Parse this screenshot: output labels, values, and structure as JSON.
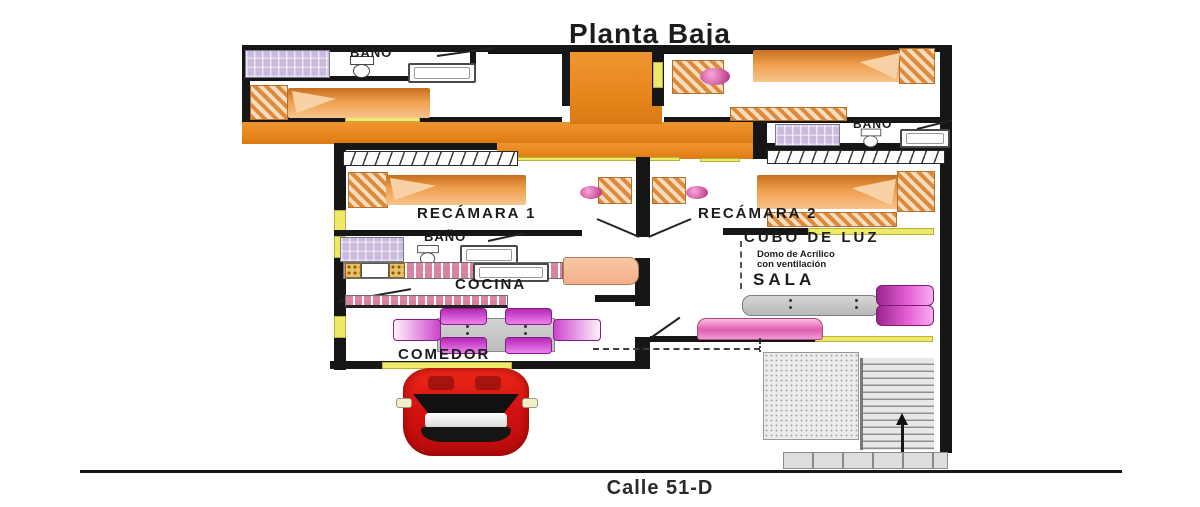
{
  "title": "Planta Baja",
  "street": "Calle 51-D",
  "labels": {
    "bano_top_left": "BAÑO",
    "bano_right": "BAÑO",
    "bano_middle": "BAÑO",
    "recamara_1": "RECÁMARA 1",
    "recamara_2": "RECÁMARA 2",
    "cocina": "COCINA",
    "comedor": "COMEDOR",
    "sala": "SALA",
    "cubo_de_luz": "CUBO DE LUZ",
    "cubo_note_1": "Domo de Acrílico",
    "cubo_note_2": "con ventilación"
  },
  "colors": {
    "hallway_orange": "#E8871E",
    "door_marker_yellow": "#EFE96A",
    "wall_black": "#161616",
    "furniture_magenta": "#C637C6",
    "shower_lilac": "#C9B9DE",
    "counter_pink": "#F0BCCB",
    "bed_orange": "#EF9F4E",
    "fridge_salmon": "#F6BE9C",
    "car_red": "#DD1A10"
  }
}
